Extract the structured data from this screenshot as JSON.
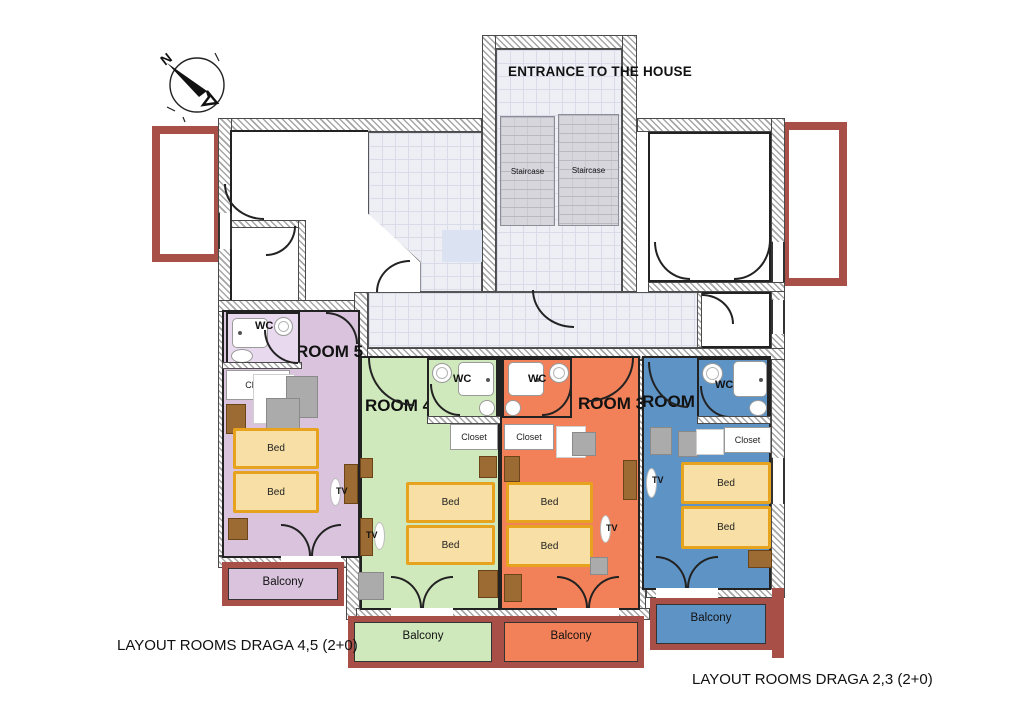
{
  "compass": {
    "north": "N"
  },
  "entrance": {
    "title": "ENTRANCE TO THE HOUSE",
    "staircase_left": "Staircase",
    "staircase_right": "Staircase"
  },
  "rooms": {
    "room5": {
      "name": "ROOM 5",
      "wc": "WC",
      "closet": "Closet",
      "bed": "Bed",
      "tv": "TV",
      "balcony": "Balcony",
      "color": "#d9c3dd"
    },
    "room4": {
      "name": "ROOM 4",
      "wc": "WC",
      "closet": "Closet",
      "bed": "Bed",
      "tv": "TV",
      "balcony": "Balcony",
      "color": "#cfe9bd"
    },
    "room3": {
      "name": "ROOM 3",
      "wc": "WC",
      "closet": "Closet",
      "bed": "Bed",
      "tv": "TV",
      "balcony": "Balcony",
      "color": "#f2815a"
    },
    "room2": {
      "name": "ROOM 2",
      "wc": "WC",
      "closet": "Closet",
      "bed": "Bed",
      "tv": "TV",
      "balcony": "Balcony",
      "color": "#5e93c5"
    }
  },
  "footer": {
    "left": "LAYOUT ROOMS DRAGA 4,5 (2+0)",
    "right": "LAYOUT ROOMS DRAGA 2,3 (2+0)"
  },
  "palette": {
    "bed_fill": "#f7dfa5",
    "bed_border": "#e8a31e",
    "terrace_railing": "#a85048",
    "tile_floor": "#edeff5",
    "staircase_gray": "#d6d6dc",
    "wood_furniture": "#9c6a33",
    "wall_outline": "#222222"
  }
}
